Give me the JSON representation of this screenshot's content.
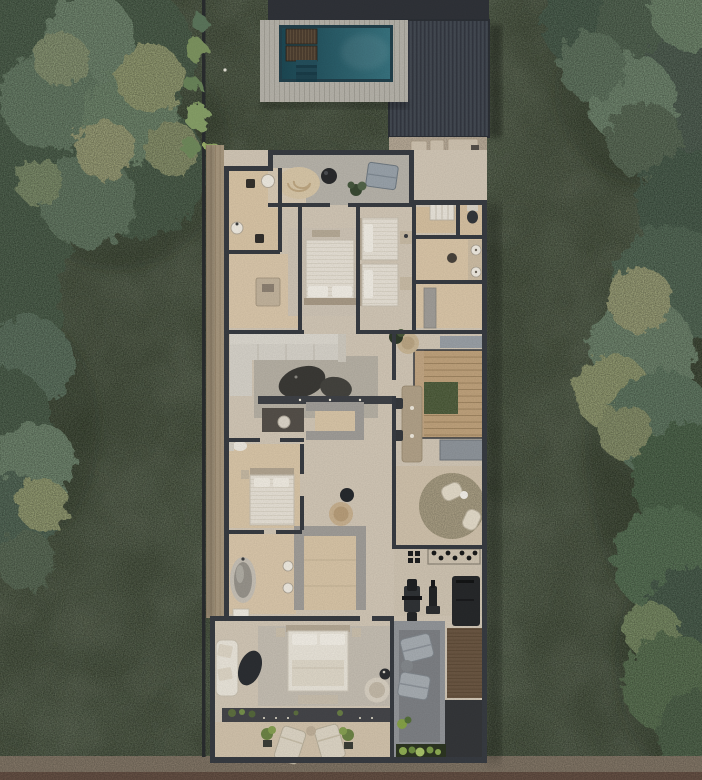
{
  "meta": {
    "alt": "Top-down 3D render of a narrow-lot residence floor plan with pool, garage roof, bedrooms, bathrooms, stair atrium, gym, master suite and street-front terrace, surrounded by lawn and tree canopies"
  },
  "colors": {
    "grass": "#3c4932",
    "grass_dark": "#2f3b28",
    "tree_base": "#41593f",
    "tree_base_right": "#3e5743",
    "tree_sage": "#6e8a6d",
    "tree_light": "#9aa46f",
    "bush": "#7d9460",
    "pool_deep": "#1d4955",
    "pool_light": "#38737f",
    "pool_border": "#22414c",
    "deck_wood": "#b6b3aa",
    "roof_flat": "#303339",
    "roof_ribbed": "#3e434c",
    "wall": "#383c42",
    "floor_main": "#d2c7b6",
    "floor_tan": "#d9c5a6",
    "floor_stone": "#b8b4ab",
    "side_path": "#a8987f",
    "stair_wood": "#c2a683",
    "atrium_green": "#3d4c2a",
    "sofa": "#d6d2c9",
    "rug_gray": "#b7b1a5",
    "bed_white": "#e9e4d9",
    "wardrobe_gray": "#a19e99",
    "lounger_brown": "#4e3f31",
    "bench_gray": "#9aa3ab",
    "table_dark": "#3b3a36",
    "deck_gray": "#93969a",
    "deck_pit": "#7e8185",
    "rug_brown": "#6b5743",
    "dark_zone": "#35373a",
    "planter_strip": "#45464a",
    "sidewalk": "#8e8170",
    "road": "#6f584b"
  }
}
